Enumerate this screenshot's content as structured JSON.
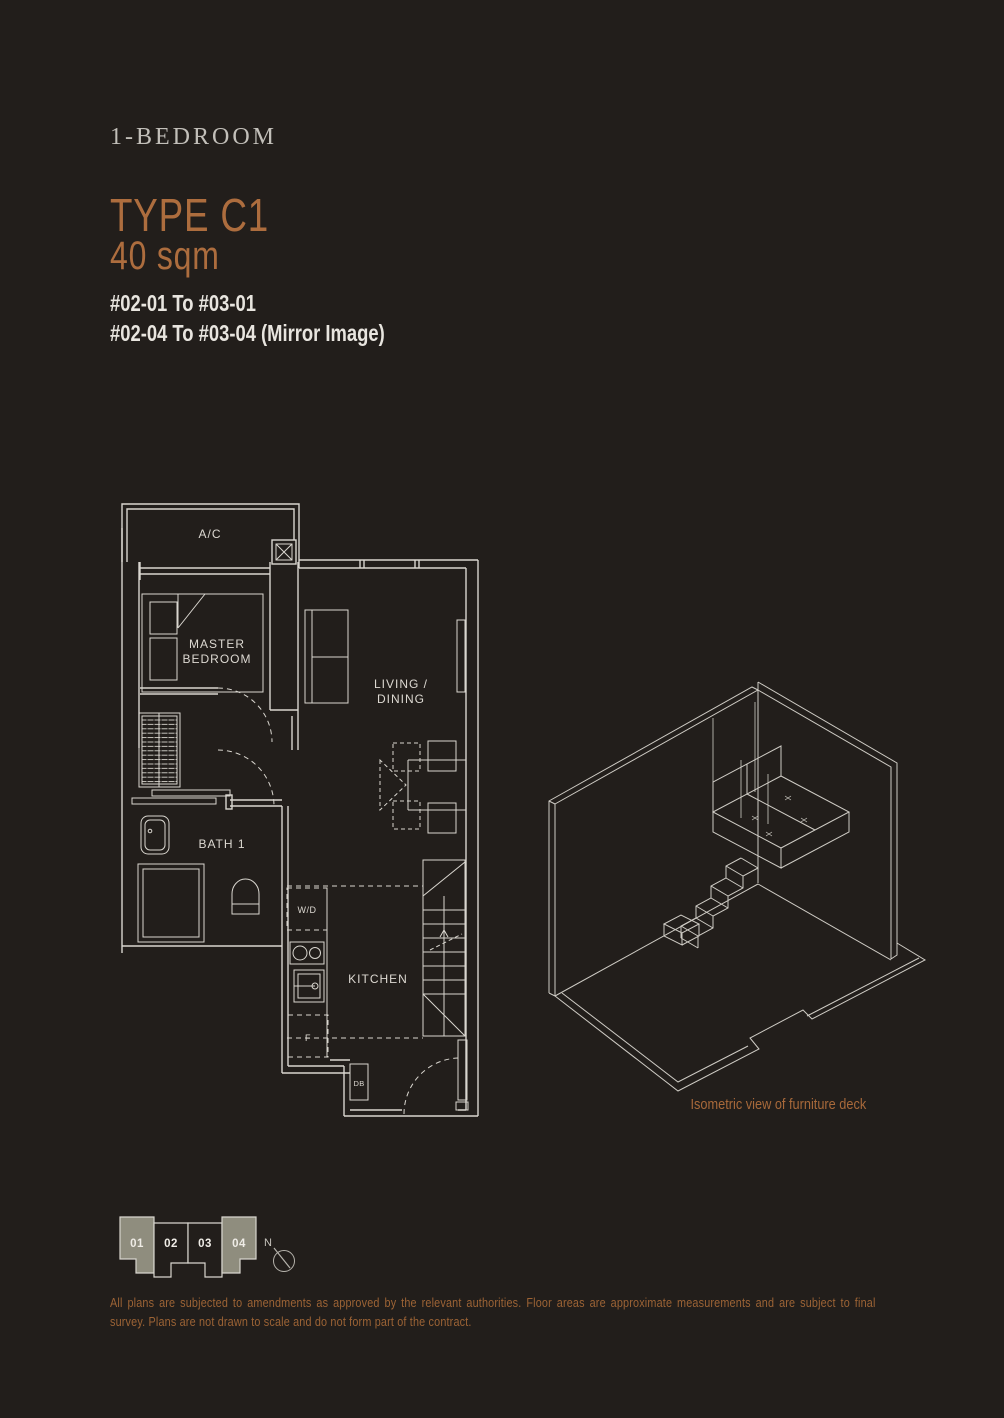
{
  "header": {
    "category": "1-BEDROOM",
    "type_title": "TYPE C1",
    "area": "40 sqm",
    "unit_range_1": "#02-01 To #03-01",
    "unit_range_2": "#02-04 To #03-04 (Mirror Image)"
  },
  "floor_plan": {
    "labels": {
      "ac": "A/C",
      "master_1": "MASTER",
      "master_2": "BEDROOM",
      "living_1": "LIVING /",
      "living_2": "DINING",
      "bath": "BATH 1",
      "washer_dryer": "W/D",
      "kitchen": "KITCHEN",
      "fridge": "F",
      "db": "DB"
    }
  },
  "isometric": {
    "caption": "Isometric view of furniture deck"
  },
  "key_plan": {
    "units": [
      {
        "label": "01",
        "highlighted": true
      },
      {
        "label": "02",
        "highlighted": false
      },
      {
        "label": "03",
        "highlighted": false
      },
      {
        "label": "04",
        "highlighted": true
      }
    ],
    "north_label": "N"
  },
  "footer": {
    "disclaimer": "All plans are subjected to amendments as approved by the relevant authorities. Floor areas are approximate measurements and are subject to final survey. Plans are not drawn to scale and do not form part of the contract."
  },
  "colors": {
    "background": "#221e1b",
    "copper_accent": "#ad6d3e",
    "copper_small_text": "#9c6335",
    "light_text": "#e8e5df",
    "plan_line": "#d9d6cf",
    "keyplan_highlight_fill": "#8f8d7e"
  }
}
